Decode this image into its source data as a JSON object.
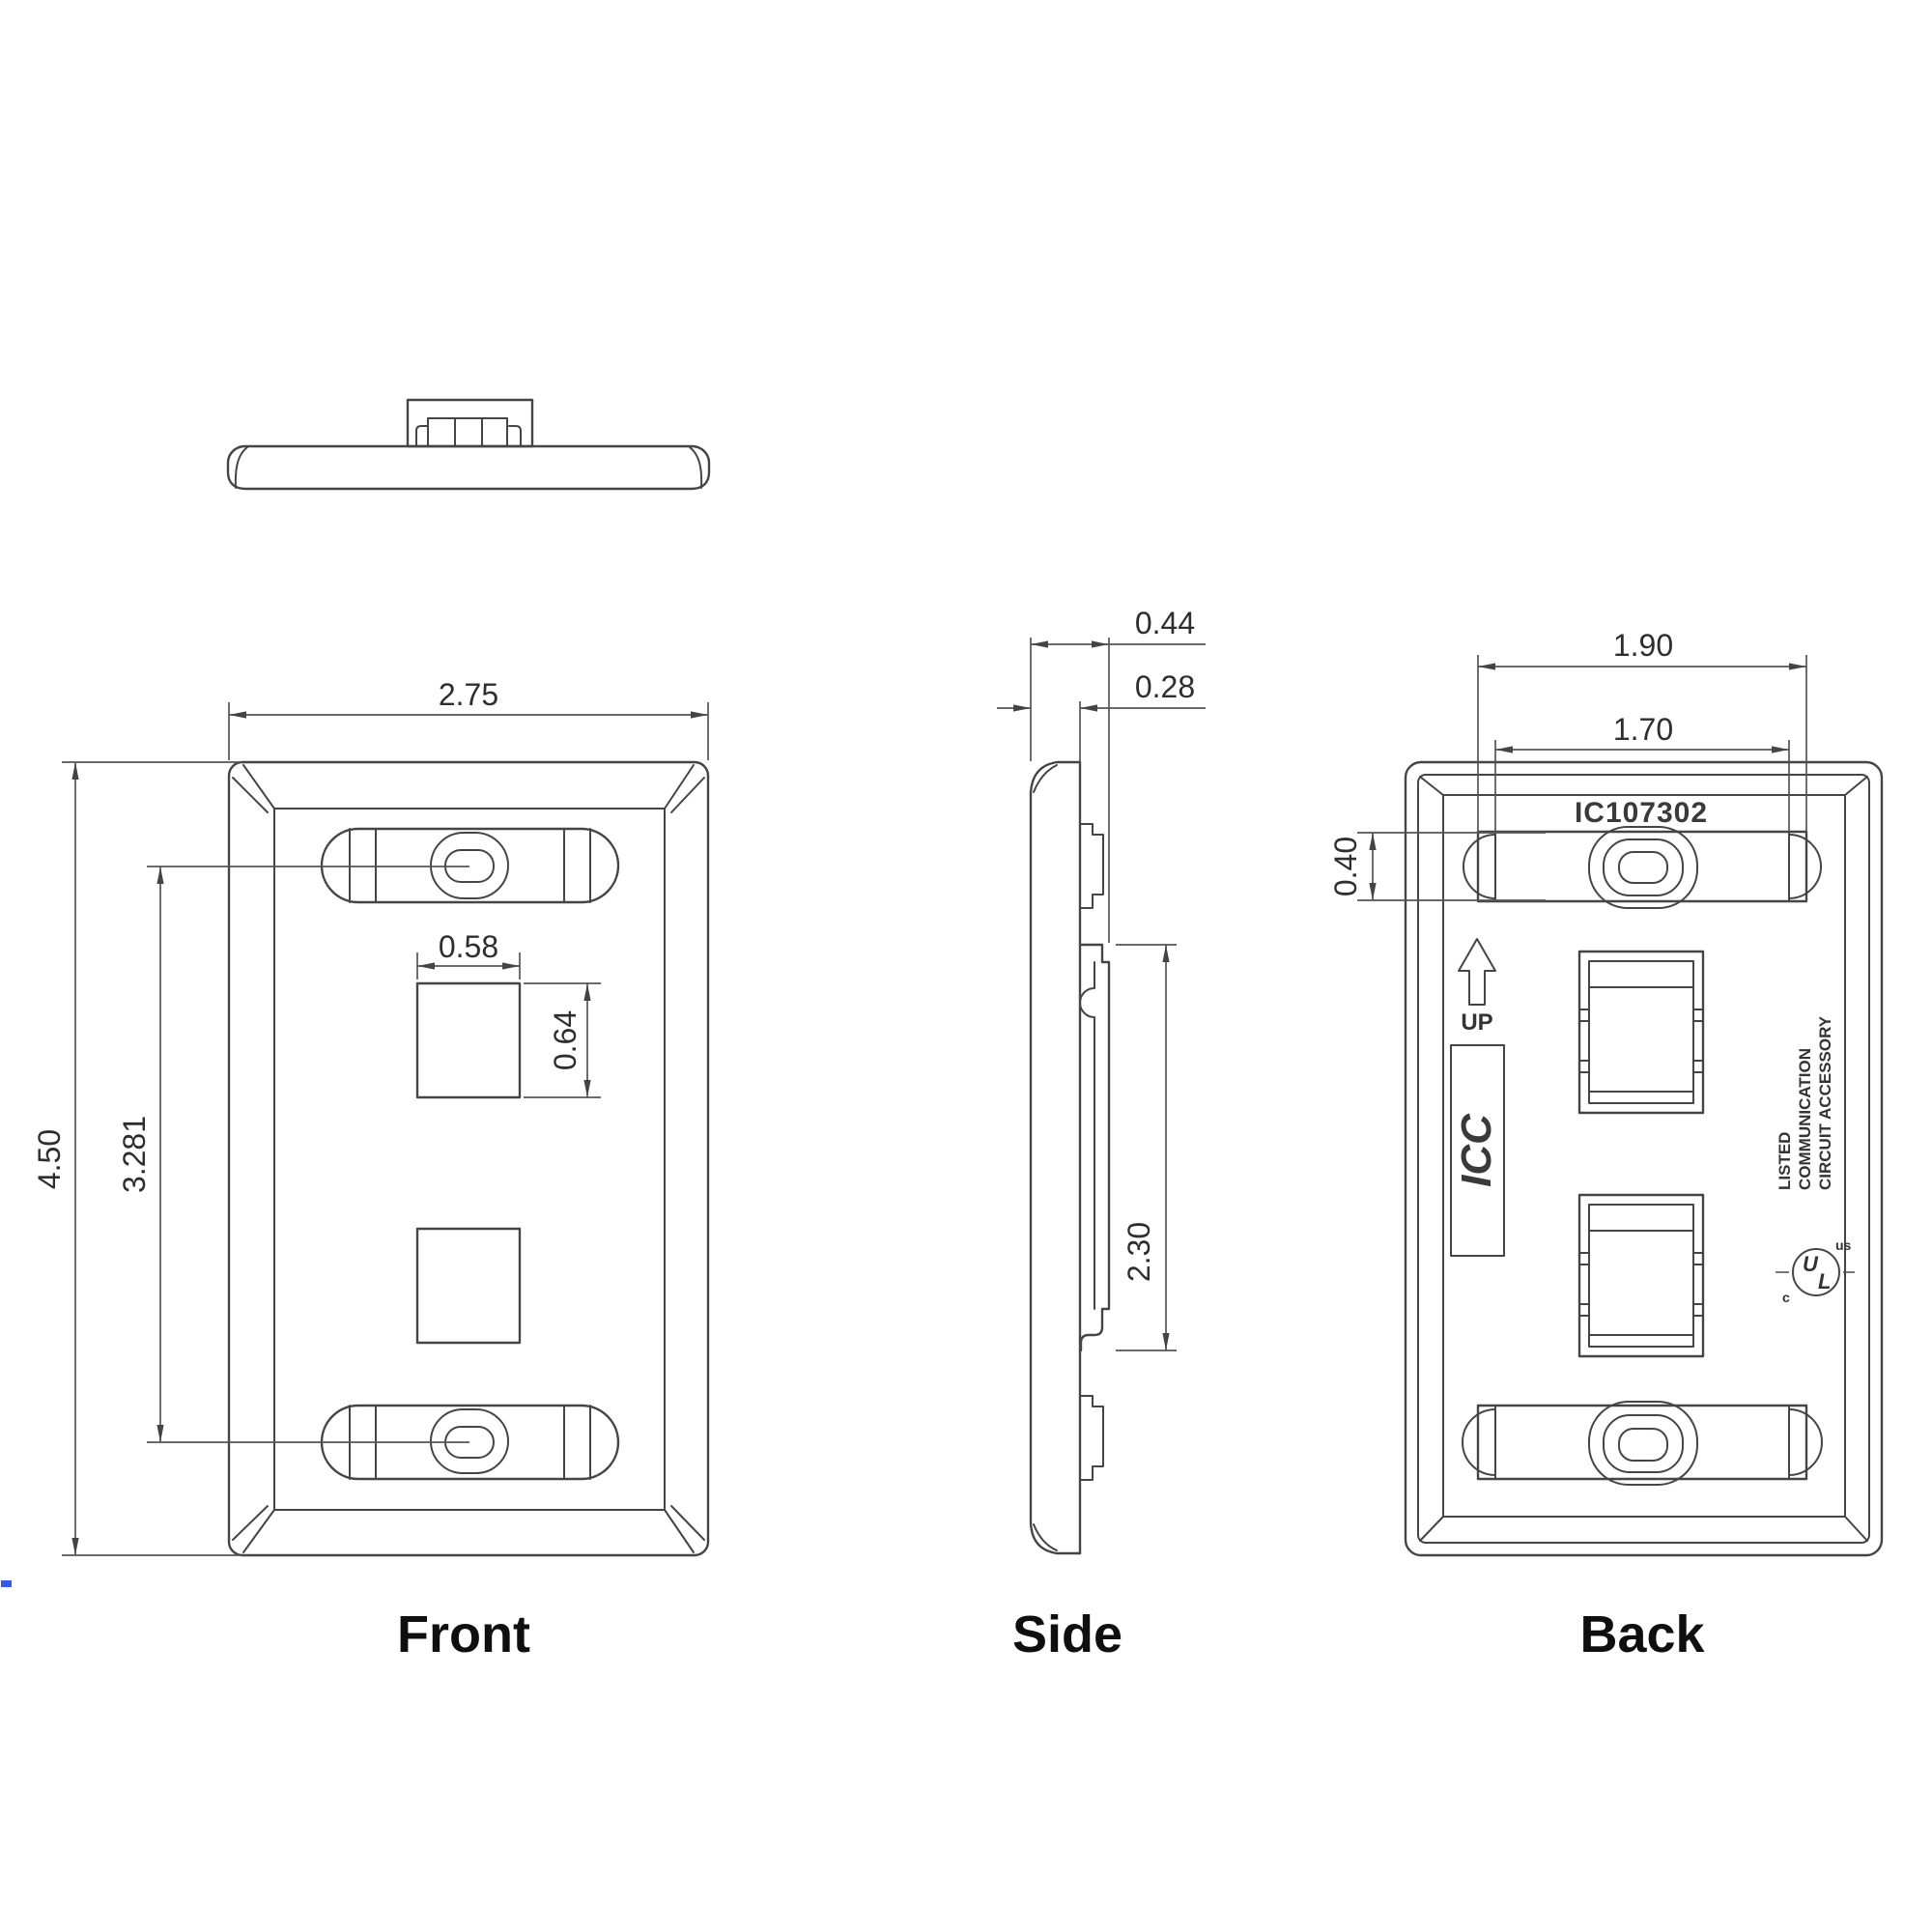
{
  "views": {
    "front": {
      "label": "Front",
      "dims": {
        "width": "2.75",
        "height": "4.50",
        "mount_spacing": "3.281",
        "port_width": "0.58",
        "port_height": "0.64"
      }
    },
    "side": {
      "label": "Side",
      "dims": {
        "depth_total": "0.44",
        "depth_edge": "0.28",
        "boss_height": "2.30"
      }
    },
    "back": {
      "label": "Back",
      "part_number": "IC107302",
      "up_label": "UP",
      "logo_text": "ICC",
      "listing": {
        "line1": "LISTED",
        "line2": "COMMUNICATION",
        "line3": "CIRCUIT ACCESSORY"
      },
      "ul": {
        "letter_u": "U",
        "letter_l": "L",
        "prefix": "c",
        "suffix": "us"
      },
      "dims": {
        "slot_width_outer": "1.90",
        "slot_width_inner": "1.70",
        "slot_height": "0.40"
      }
    }
  },
  "colors": {
    "line": "#454545",
    "dimension": "#555555",
    "text": "#2e2e2e",
    "label": "#111111",
    "artifact_blue": "#2e5fe8"
  }
}
